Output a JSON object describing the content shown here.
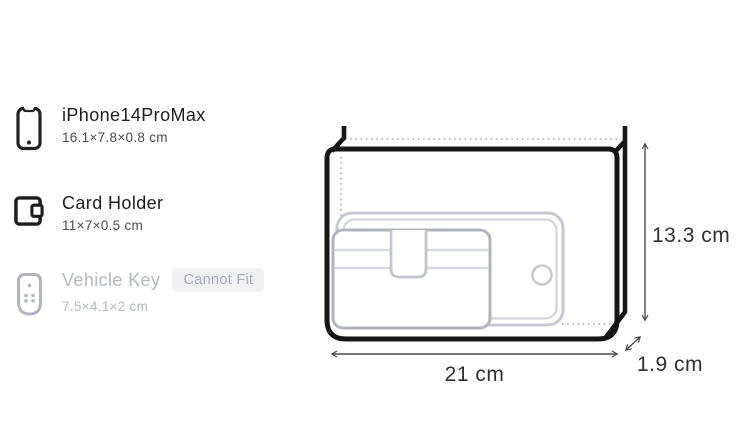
{
  "items": [
    {
      "name": "iPhone14ProMax",
      "dimensions": "16.1×7.8×0.8 cm",
      "fits": true,
      "icon": "smartphone-icon"
    },
    {
      "name": "Card Holder",
      "dimensions": "11×7×0.5 cm",
      "fits": true,
      "icon": "card-holder-icon"
    },
    {
      "name": "Vehicle Key",
      "dimensions": "7.5×4.1×2 cm",
      "fits": false,
      "badge": "Cannot Fit",
      "icon": "key-fob-icon"
    }
  ],
  "diagram": {
    "type": "bag-dimension-diagram",
    "width_label": "21 cm",
    "height_label": "13.3 cm",
    "depth_label": "1.9 cm",
    "contents_shown": [
      "smartphone-outline",
      "card-holder-outline"
    ]
  },
  "colors": {
    "title_text": "#1d1d1f",
    "subtext": "#4b4b4d",
    "disabled_text": "#b5b8c0",
    "badge_background": "#f0f0f3",
    "badge_text": "#a9adb6",
    "bag_outline": "#161616",
    "phone_ghost_outline": "#c7c9d0",
    "card_ghost_outline": "#b1b4bd",
    "dimension_text": "#2f2f2f",
    "arrow": "#4a4a4a"
  }
}
